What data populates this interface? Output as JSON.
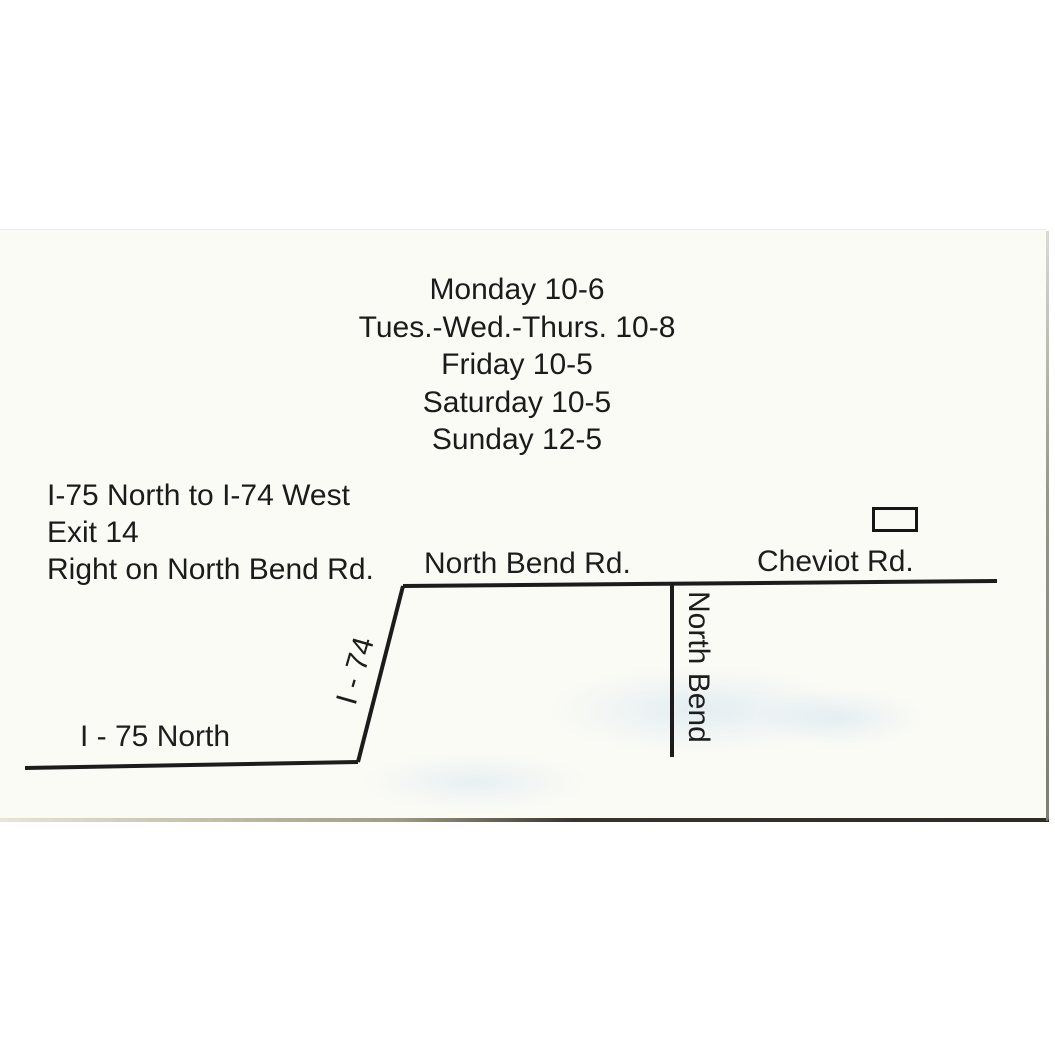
{
  "hours": {
    "lines": [
      "Monday 10-6",
      "Tues.-Wed.-Thurs. 10-8",
      "Friday 10-5",
      "Saturday 10-5",
      "Sunday 12-5"
    ]
  },
  "directions": {
    "lines": [
      "I-75 North to I-74 West",
      "Exit 14",
      "Right on North Bend Rd."
    ]
  },
  "map": {
    "labels": {
      "main_road": "North Bend Rd.",
      "cross_road": "Cheviot Rd.",
      "highway_diagonal": "I - 74",
      "highway_bottom": "I - 75 North",
      "vertical_street": "North Bend"
    },
    "colors": {
      "ink": "#1c1c1c",
      "card_paper": "#fbfbf5",
      "card_edge_dark": "#2d2b23",
      "card_edge_gray": "#96968f"
    }
  }
}
